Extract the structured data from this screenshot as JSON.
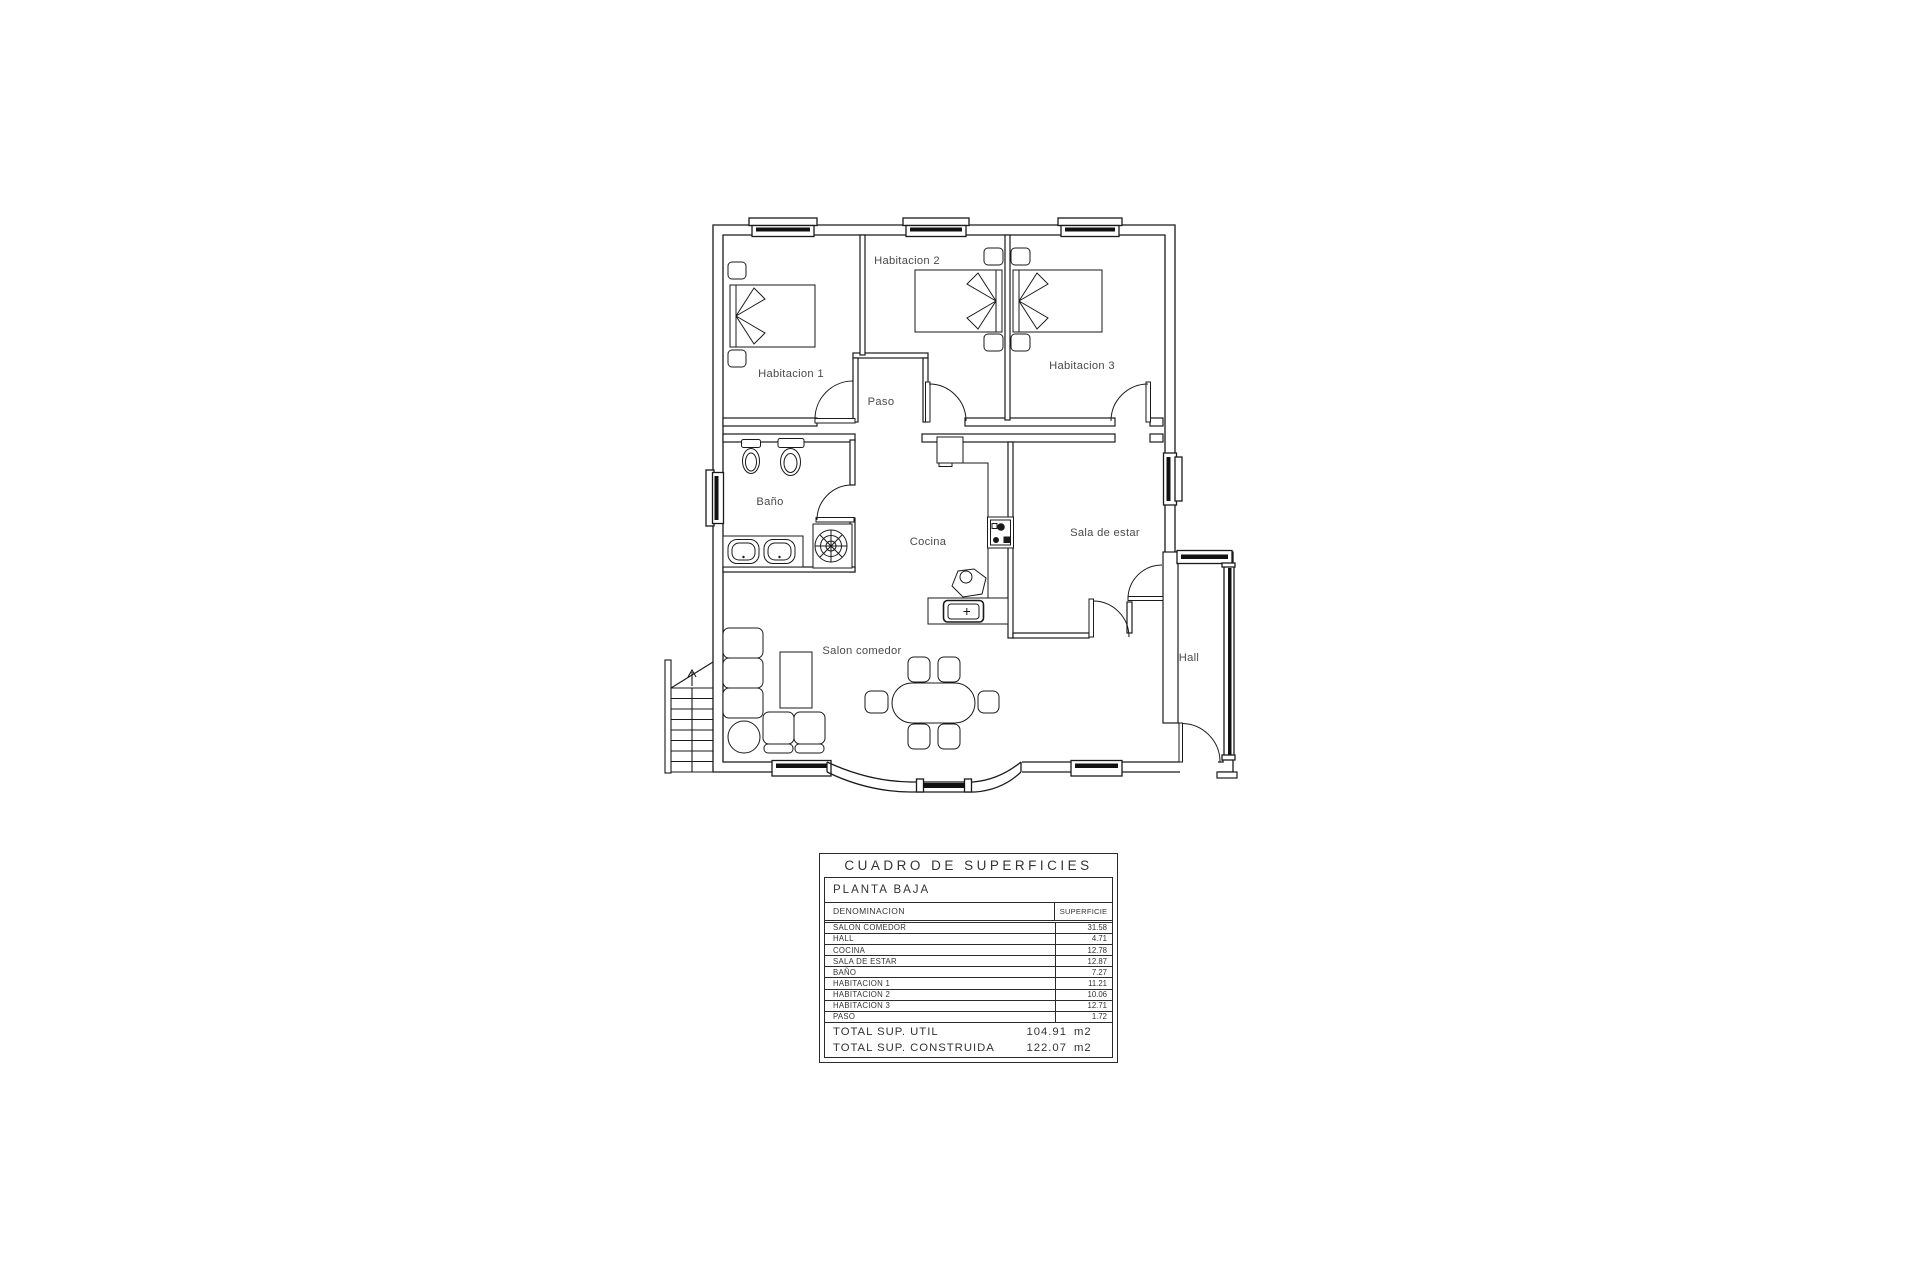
{
  "plan": {
    "labels": {
      "habitacion1": "Habitacion 1",
      "habitacion2": "Habitacion 2",
      "habitacion3": "Habitacion 3",
      "paso": "Paso",
      "bano": "Baño",
      "cocina": "Cocina",
      "sala": "Sala de estar",
      "salon": "Salon comedor",
      "hall": "Hall"
    },
    "line_color": "#1a1a1a"
  },
  "table": {
    "title": "CUADRO DE SUPERFICIES",
    "floor": "PLANTA BAJA",
    "col_name": "DENOMINACION",
    "col_value": "SUPERFICIE",
    "rows": [
      {
        "name": "SALON COMEDOR",
        "value": "31.58"
      },
      {
        "name": "HALL",
        "value": "4.71"
      },
      {
        "name": "COCINA",
        "value": "12.78"
      },
      {
        "name": "SALA DE ESTAR",
        "value": "12.87"
      },
      {
        "name": "BAÑO",
        "value": "7.27"
      },
      {
        "name": "HABITACION 1",
        "value": "11.21"
      },
      {
        "name": "HABITACION 2",
        "value": "10.06"
      },
      {
        "name": "HABITACION 3",
        "value": "12.71"
      },
      {
        "name": "PASO",
        "value": "1.72"
      }
    ],
    "totals": [
      {
        "label": "TOTAL SUP. UTIL",
        "value": "104.91",
        "unit": "m2"
      },
      {
        "label": "TOTAL SUP. CONSTRUIDA",
        "value": "122.07",
        "unit": "m2"
      }
    ]
  }
}
